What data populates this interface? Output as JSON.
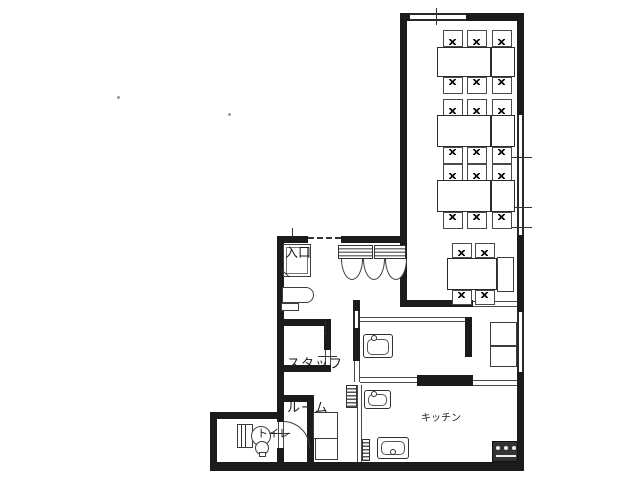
{
  "labels": {
    "entrance": "入口",
    "staff_room": [
      "スタッフ",
      "ルーム"
    ],
    "toilet": "トイレ",
    "kitchen": "キッチン"
  },
  "colors": {
    "wall": "#1b1b1b",
    "line": "#3d3d3d",
    "background": "#ffffff"
  },
  "inventory": {
    "dining_table_groups": 4,
    "dining_chairs": 22,
    "counter_stools": 3,
    "sinks": 3,
    "stoves": 1,
    "toilets": 1
  }
}
